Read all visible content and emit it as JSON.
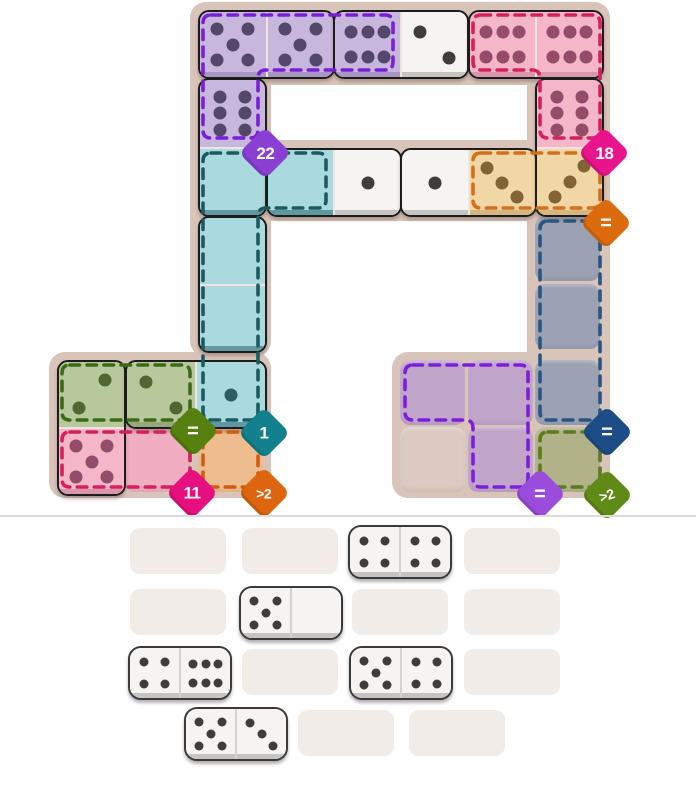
{
  "colors": {
    "page_bg": "#ffffff",
    "board_base": "#d9c4ba",
    "divider": "#dcdcdc",
    "tray_slot": "#f2ece8",
    "board_domino_outline": "#1c1c1c",
    "tray_domino_outline": "#3a3a3a",
    "tints": {
      "white": {
        "fill": "#f5f4f2",
        "lip": "#c6c4c1",
        "pip": "#3d3d3d"
      },
      "purple": {
        "fill": "#c8b7dc",
        "lip": "#a897c0",
        "pip": "#53486a"
      },
      "pink": {
        "fill": "#f4b6c8",
        "lip": "#d897ad",
        "pip": "#944d68"
      },
      "teal": {
        "fill": "#aadadd",
        "lip": "#5f98a0",
        "pip": "#2f5d63"
      },
      "orange": {
        "fill": "#f2d7a6",
        "lip": "#d5b77f",
        "pip": "#826336"
      },
      "green": {
        "fill": "#b7c89c",
        "lip": "#97a97c",
        "pip": "#516630"
      }
    },
    "cell_fills": {
      "gray": "#9aa2b3",
      "olive": "#b2b289",
      "purple": "#c1a4ca",
      "beige": "#dccac3",
      "pink": "#f0aec2",
      "orange": "#eebd8d"
    }
  },
  "board": {
    "width": 696,
    "height": 515,
    "base_shapes": [
      {
        "x": 190,
        "y": 2,
        "w": 420,
        "h": 83
      },
      {
        "x": 190,
        "y": 2,
        "w": 81,
        "h": 355
      },
      {
        "x": 527,
        "y": 2,
        "w": 83,
        "h": 496
      },
      {
        "x": 190,
        "y": 140,
        "w": 420,
        "h": 81
      },
      {
        "x": 49,
        "y": 352,
        "w": 222,
        "h": 146
      },
      {
        "x": 392,
        "y": 352,
        "w": 218,
        "h": 146
      }
    ],
    "empty_cells": [
      {
        "name": "gray-cell-1",
        "x": 535,
        "y": 216,
        "fill": "gray"
      },
      {
        "name": "gray-cell-2",
        "x": 535,
        "y": 284,
        "fill": "gray"
      },
      {
        "name": "gray-cell-3",
        "x": 535,
        "y": 360,
        "fill": "gray"
      },
      {
        "name": "olive-cell",
        "x": 535,
        "y": 427,
        "fill": "olive"
      },
      {
        "name": "purple-cell-1",
        "x": 400,
        "y": 360,
        "fill": "purple"
      },
      {
        "name": "purple-cell-2",
        "x": 468,
        "y": 360,
        "fill": "purple"
      },
      {
        "name": "purple-cell-3",
        "x": 468,
        "y": 427,
        "fill": "purple"
      },
      {
        "name": "plain-cell",
        "x": 400,
        "y": 427,
        "fill": "beige"
      },
      {
        "name": "pink-cell",
        "x": 125,
        "y": 427,
        "fill": "pink"
      },
      {
        "name": "orange-cell",
        "x": 198,
        "y": 427,
        "fill": "orange"
      }
    ],
    "placed_dominoes": [
      {
        "name": "placed-domino-5-5",
        "x": 198,
        "y": 10,
        "dir": "h",
        "len": 133,
        "halves": [
          {
            "value": 5,
            "pattern": "5",
            "tint": "purple"
          },
          {
            "value": 5,
            "pattern": "5",
            "tint": "purple"
          }
        ]
      },
      {
        "name": "placed-domino-6-2",
        "x": 333,
        "y": 10,
        "dir": "h",
        "len": 132,
        "halves": [
          {
            "value": 6,
            "pattern": "6h",
            "tint": "purple"
          },
          {
            "value": 2,
            "pattern": "2a",
            "tint": "white"
          }
        ]
      },
      {
        "name": "placed-domino-6-6",
        "x": 468,
        "y": 10,
        "dir": "h",
        "len": 132,
        "halves": [
          {
            "value": 6,
            "pattern": "6h",
            "tint": "pink"
          },
          {
            "value": 6,
            "pattern": "6h",
            "tint": "pink"
          }
        ]
      },
      {
        "name": "placed-domino-6-0",
        "x": 198,
        "y": 78,
        "dir": "v",
        "len": 135,
        "halves": [
          {
            "value": 6,
            "pattern": "6v",
            "tint": "purple"
          },
          {
            "value": 0,
            "pattern": "0",
            "tint": "teal"
          }
        ]
      },
      {
        "name": "placed-domino-0-1",
        "x": 266,
        "y": 148,
        "dir": "h",
        "len": 132,
        "halves": [
          {
            "value": 0,
            "pattern": "0",
            "tint": "teal"
          },
          {
            "value": 1,
            "pattern": "1",
            "tint": "white"
          }
        ]
      },
      {
        "name": "placed-domino-1-3",
        "x": 400,
        "y": 148,
        "dir": "h",
        "len": 133,
        "halves": [
          {
            "value": 1,
            "pattern": "1",
            "tint": "white"
          },
          {
            "value": 3,
            "pattern": "3a",
            "tint": "orange"
          }
        ]
      },
      {
        "name": "placed-domino-6-3",
        "x": 535,
        "y": 78,
        "dir": "v",
        "len": 135,
        "halves": [
          {
            "value": 6,
            "pattern": "6v",
            "tint": "pink"
          },
          {
            "value": 3,
            "pattern": "3b",
            "tint": "orange"
          }
        ]
      },
      {
        "name": "placed-domino-0-0",
        "x": 198,
        "y": 216,
        "dir": "v",
        "len": 133,
        "halves": [
          {
            "value": 0,
            "pattern": "0",
            "tint": "teal"
          },
          {
            "value": 0,
            "pattern": "0",
            "tint": "teal"
          }
        ]
      },
      {
        "name": "placed-domino-2-5",
        "x": 57,
        "y": 360,
        "dir": "v",
        "len": 132,
        "halves": [
          {
            "value": 2,
            "pattern": "2b",
            "tint": "green"
          },
          {
            "value": 5,
            "pattern": "5",
            "tint": "pink"
          }
        ]
      },
      {
        "name": "placed-domino-2-1",
        "x": 125,
        "y": 360,
        "dir": "h",
        "len": 138,
        "halves": [
          {
            "value": 2,
            "pattern": "2a",
            "tint": "green"
          },
          {
            "value": 1,
            "pattern": "1",
            "tint": "teal"
          }
        ]
      }
    ],
    "regions": [
      {
        "name": "region-purple-sum-22",
        "dash": "#7a1fd8",
        "path": "M 211 15 H 385 Q 393 15 393 23 V 62 Q 393 70 385 70 H 266 Q 258 70 258 78 V 130 Q 258 138 250 138 H 211 Q 203 138 203 130 V 23 Q 203 15 211 15 Z",
        "badge": {
          "label": "22",
          "color": "#8a3fd3",
          "x": 265,
          "y": 153,
          "kind": "num"
        }
      },
      {
        "name": "region-pink-sum-18",
        "dash": "#d6205c",
        "path": "M 481 15 H 592 Q 600 15 600 23 V 130 Q 600 138 592 138 H 548 Q 540 138 540 130 V 78 Q 540 70 532 70 H 481 Q 473 70 473 62 V 23 Q 473 15 481 15 Z",
        "badge": {
          "label": "18",
          "color": "#e8148b",
          "x": 604,
          "y": 153,
          "kind": "num"
        }
      },
      {
        "name": "region-orange-equal",
        "dash": "#d2711d",
        "path": "M 481 153 H 592 Q 600 153 600 161 V 200 Q 600 208 592 208 H 481 Q 473 208 473 200 V 161 Q 473 153 481 153 Z",
        "badge": {
          "label": "=",
          "color": "#dc6b0e",
          "x": 606,
          "y": 223,
          "kind": "eq"
        }
      },
      {
        "name": "region-teal-sum-1",
        "dash": "#1b5a60",
        "path": "M 211 153 H 318 Q 326 153 326 161 V 200 Q 326 208 318 208 H 266 Q 258 208 258 216 V 412 Q 258 420 250 420 H 211 Q 203 420 203 412 V 161 Q 203 153 211 153 Z",
        "badge": {
          "label": "1",
          "color": "#13808e",
          "x": 264,
          "y": 433,
          "kind": "num"
        }
      },
      {
        "name": "region-gray-equal",
        "dash": "#2a5580",
        "path": "M 548 221 H 592 Q 600 221 600 229 V 412 Q 600 420 592 420 H 548 Q 540 420 540 412 V 229 Q 540 221 548 221 Z",
        "badge": {
          "label": "=",
          "color": "#1d4d87",
          "x": 607,
          "y": 432,
          "kind": "eq"
        }
      },
      {
        "name": "region-olive-greater-2",
        "dash": "#5c7a1f",
        "path": "M 548 432 H 592 Q 600 432 600 440 V 479 Q 600 487 592 487 H 548 Q 540 487 540 479 V 440 Q 540 432 548 432 Z",
        "badge": {
          "label": ">2",
          "color": "#5f8a15",
          "x": 607,
          "y": 495,
          "kind": "gt",
          "tilt": -18
        }
      },
      {
        "name": "region-purple-equal",
        "dash": "#7d1fd9",
        "path": "M 413 365 H 520 Q 528 365 528 373 V 479 Q 528 487 520 487 H 481 Q 473 487 473 479 V 428 Q 473 420 465 420 H 413 Q 405 420 405 412 V 373 Q 405 365 413 365 Z",
        "badge": {
          "label": "=",
          "color": "#9a4ddb",
          "x": 540,
          "y": 494,
          "kind": "eq"
        }
      },
      {
        "name": "region-green-equal",
        "dash": "#3c6b15",
        "path": "M 70 365 H 182 Q 190 365 190 373 V 412 Q 190 420 182 420 H 70 Q 62 420 62 412 V 373 Q 62 365 70 365 Z",
        "badge": {
          "label": "=",
          "color": "#56810f",
          "x": 193,
          "y": 431,
          "kind": "eq"
        }
      },
      {
        "name": "region-pink-sum-11",
        "dash": "#d6205c",
        "path": "M 70 432 H 182 Q 190 432 190 440 V 479 Q 190 487 182 487 H 70 Q 62 487 62 479 V 440 Q 62 432 70 432 Z",
        "badge": {
          "label": "11",
          "color": "#e60f7e",
          "x": 192,
          "y": 493,
          "kind": "num"
        }
      },
      {
        "name": "region-orange-greater-2",
        "dash": "#cf5c13",
        "path": "M 211 432 H 250 Q 258 432 258 440 V 479 Q 258 487 250 487 H 211 Q 203 487 203 479 V 440 Q 203 432 211 432 Z",
        "badge": {
          "label": ">2",
          "color": "#dd650e",
          "x": 264,
          "y": 493,
          "kind": "gt"
        }
      }
    ]
  },
  "divider": {
    "y": 515
  },
  "tray": {
    "slot_w": 96,
    "slot_h": 46,
    "slots": [
      {
        "x": 130,
        "y": 528
      },
      {
        "x": 242,
        "y": 528
      },
      {
        "x": 352,
        "y": 528
      },
      {
        "x": 464,
        "y": 528
      },
      {
        "x": 130,
        "y": 589
      },
      {
        "x": 242,
        "y": 589
      },
      {
        "x": 352,
        "y": 589
      },
      {
        "x": 464,
        "y": 589
      },
      {
        "x": 130,
        "y": 649
      },
      {
        "x": 242,
        "y": 649
      },
      {
        "x": 352,
        "y": 649
      },
      {
        "x": 464,
        "y": 649
      },
      {
        "x": 187,
        "y": 710
      },
      {
        "x": 298,
        "y": 710
      },
      {
        "x": 409,
        "y": 710
      }
    ],
    "dominoes": [
      {
        "name": "tray-domino-4-4",
        "x": 348,
        "y": 525,
        "halves": [
          {
            "value": 4,
            "pattern": "4"
          },
          {
            "value": 4,
            "pattern": "4"
          }
        ]
      },
      {
        "name": "tray-domino-5-0",
        "x": 239,
        "y": 586,
        "halves": [
          {
            "value": 5,
            "pattern": "5"
          },
          {
            "value": 0,
            "pattern": "0"
          }
        ]
      },
      {
        "name": "tray-domino-4-6",
        "x": 128,
        "y": 646,
        "halves": [
          {
            "value": 4,
            "pattern": "4"
          },
          {
            "value": 6,
            "pattern": "6h"
          }
        ]
      },
      {
        "name": "tray-domino-5-4",
        "x": 349,
        "y": 646,
        "halves": [
          {
            "value": 5,
            "pattern": "5"
          },
          {
            "value": 4,
            "pattern": "4"
          }
        ]
      },
      {
        "name": "tray-domino-5-3",
        "x": 184,
        "y": 707,
        "halves": [
          {
            "value": 5,
            "pattern": "5"
          },
          {
            "value": 3,
            "pattern": "3a"
          }
        ]
      }
    ]
  }
}
